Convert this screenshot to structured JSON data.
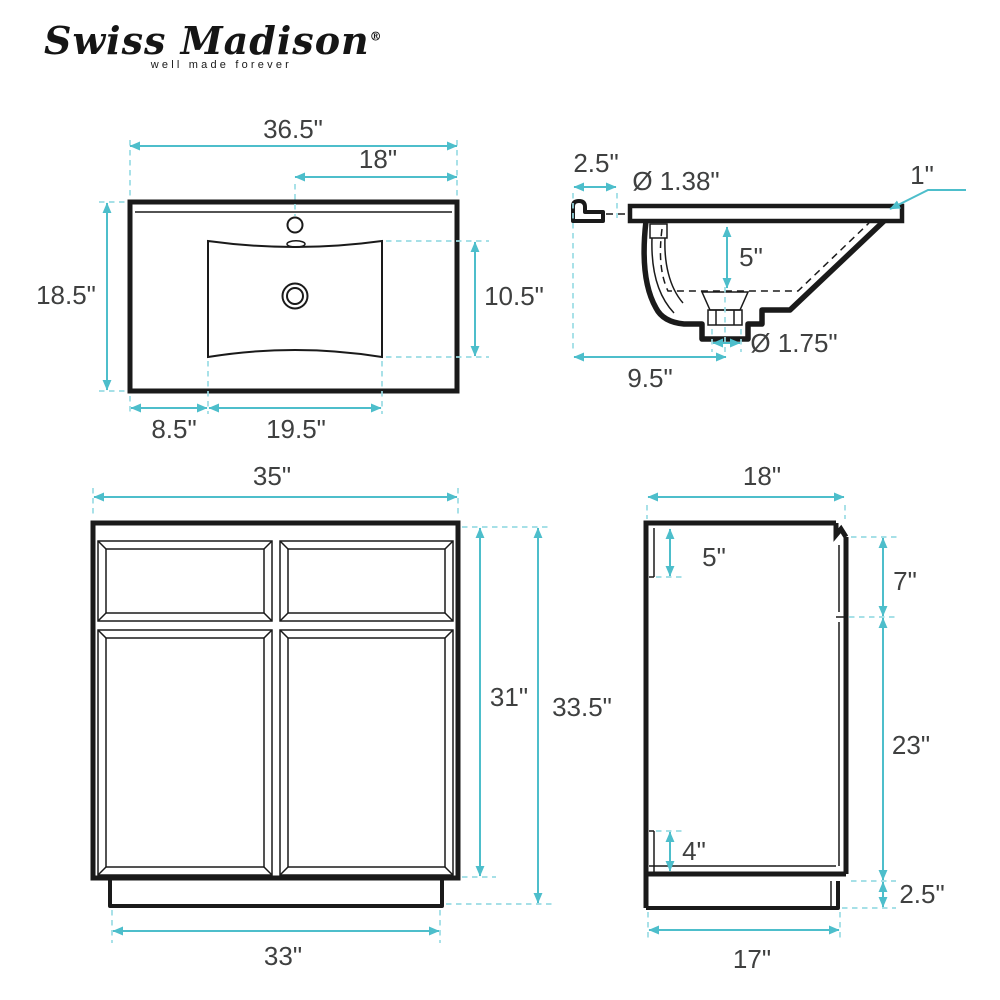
{
  "brand": {
    "name": "Swiss Madison",
    "registered_mark": "®",
    "tagline": "well made forever"
  },
  "colors": {
    "dimension_line": "#4DBECB",
    "extension_line": "#9ADCE4",
    "drawing_ink": "#1A1A1A",
    "label_text": "#3F4040",
    "background": "#FFFFFF"
  },
  "views": {
    "sink_top": {
      "dims": {
        "overall_width": "36.5\"",
        "faucet_to_right_edge": "18\"",
        "overall_depth": "18.5\"",
        "basin_front_to_back": "10.5\"",
        "left_edge_to_basin": "8.5\"",
        "basin_width": "19.5\""
      }
    },
    "sink_section": {
      "dims": {
        "backsplash_depth": "2.5\"",
        "faucet_hole_diameter": "Ø 1.38\"",
        "countertop_thickness": "1\"",
        "basin_depth": "5\"",
        "drain_diameter": "Ø 1.75\"",
        "back_to_drain_center": "9.5\""
      }
    },
    "cabinet_front": {
      "dims": {
        "cabinet_width": "35\"",
        "door_height": "31\"",
        "total_height": "33.5\"",
        "base_width": "33\""
      }
    },
    "cabinet_side": {
      "dims": {
        "cabinet_depth": "18\"",
        "top_back_panel": "5\"",
        "drawer_front_side": "7\"",
        "door_front_side": "23\"",
        "bottom_back_panel": "4\"",
        "toe_kick_height": "2.5\"",
        "base_depth": "17\""
      }
    }
  }
}
